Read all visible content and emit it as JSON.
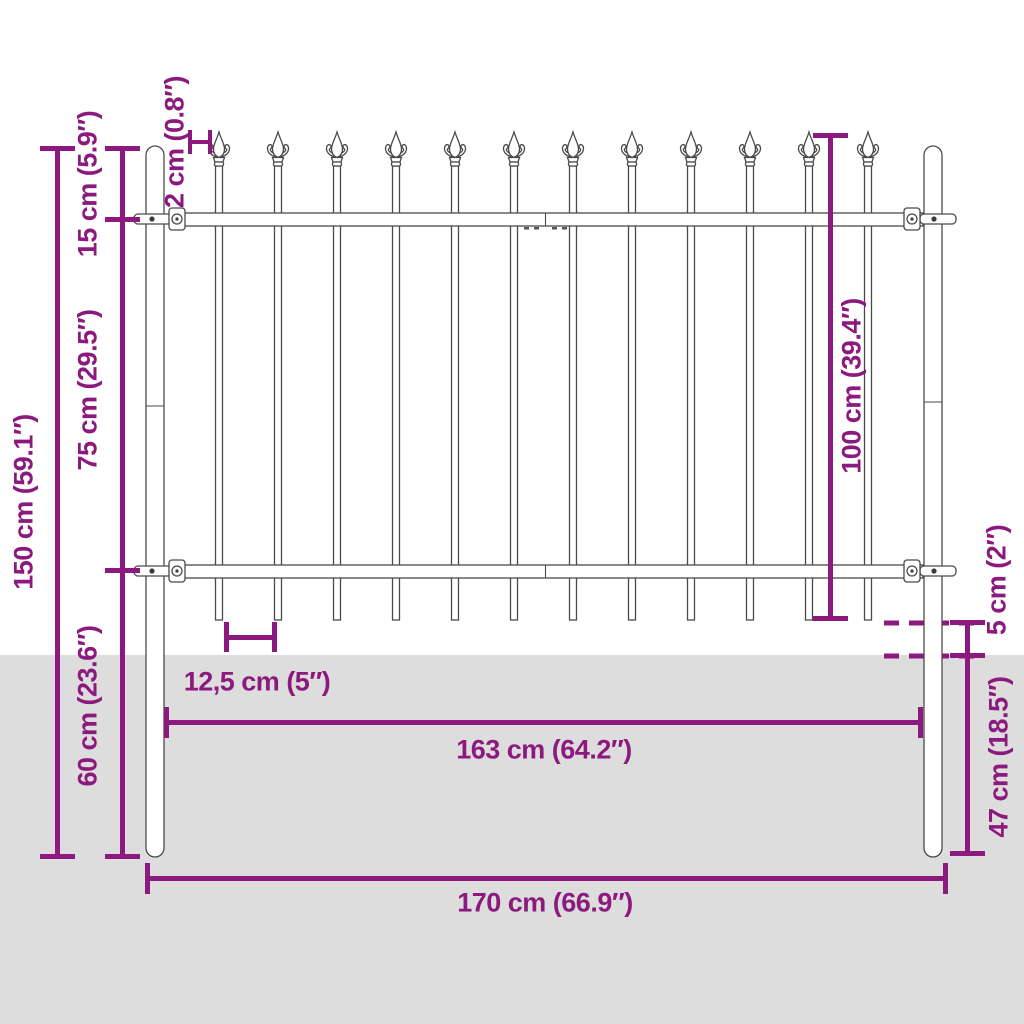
{
  "diagram": {
    "title": "fence panel with spear top - dimension drawing",
    "labels": {
      "overall_height": "150 cm (59.1″)",
      "section_top": "15 cm (5.9″)",
      "section_middle": "75 cm (29.5″)",
      "section_bottom": "60 cm (23.6″)",
      "spear_width": "2 cm (0.8″)",
      "panel_height": "100 cm (39.4″)",
      "ground_clearance": "5 cm (2″)",
      "buried_depth": "47 cm (18.5″)",
      "picket_spacing": "12,5 cm (5″)",
      "panel_width": "163 cm (64.2″)",
      "overall_width": "170 cm (66.9″)"
    },
    "picket_count": 12,
    "colors": {
      "dimension": "#8C1A7E",
      "ground": "#DDDDDD",
      "fence_outline": "#4A4A4A",
      "fence_fill": "#FFFFFF"
    }
  }
}
